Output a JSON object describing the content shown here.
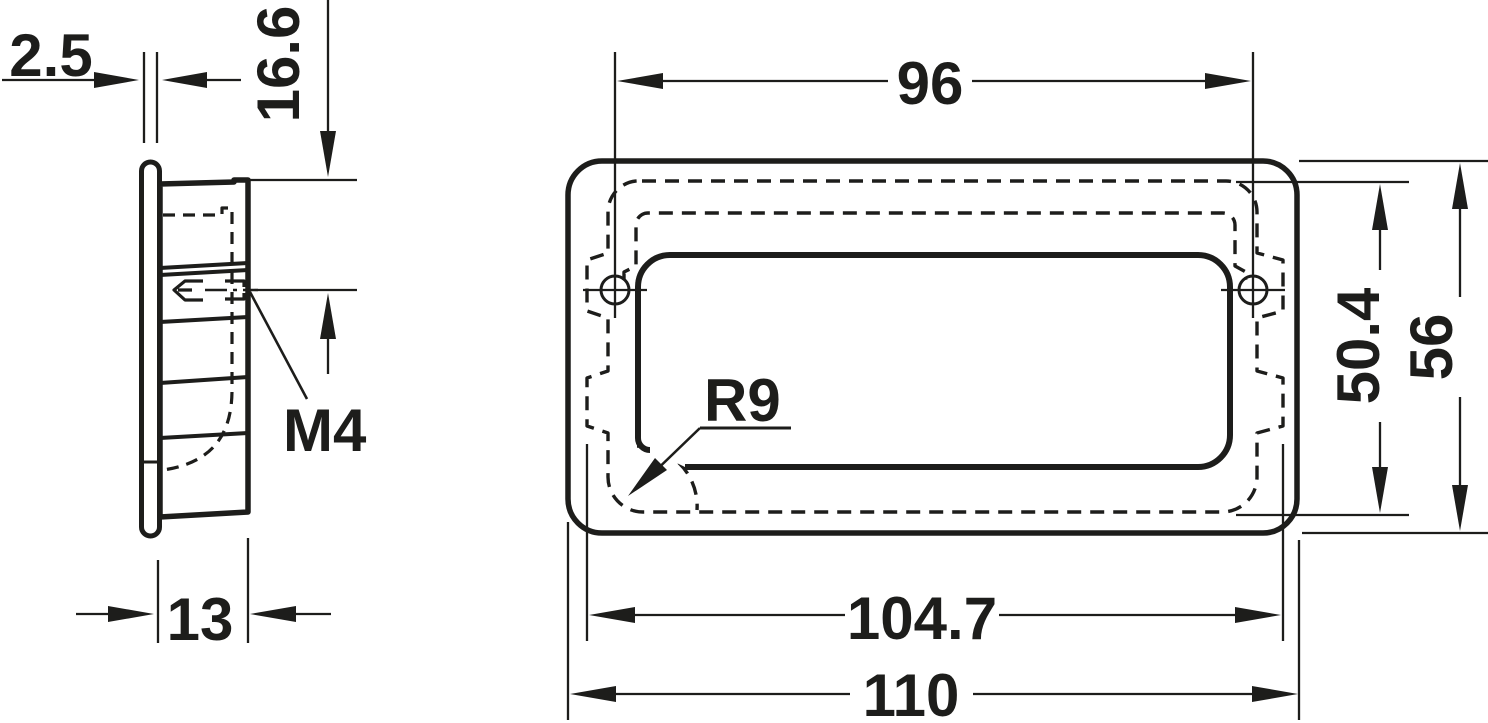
{
  "drawing": {
    "ink": "#1d1d1b",
    "background": "#ffffff",
    "dims": {
      "flange_thickness": "2.5",
      "top_to_hole": "16.6",
      "thread": "M4",
      "depth": "13",
      "hole_spacing": "96",
      "recess_height": "50.4",
      "height": "56",
      "recess_width": "104.7",
      "width": "110",
      "corner_radius": "R9"
    }
  }
}
